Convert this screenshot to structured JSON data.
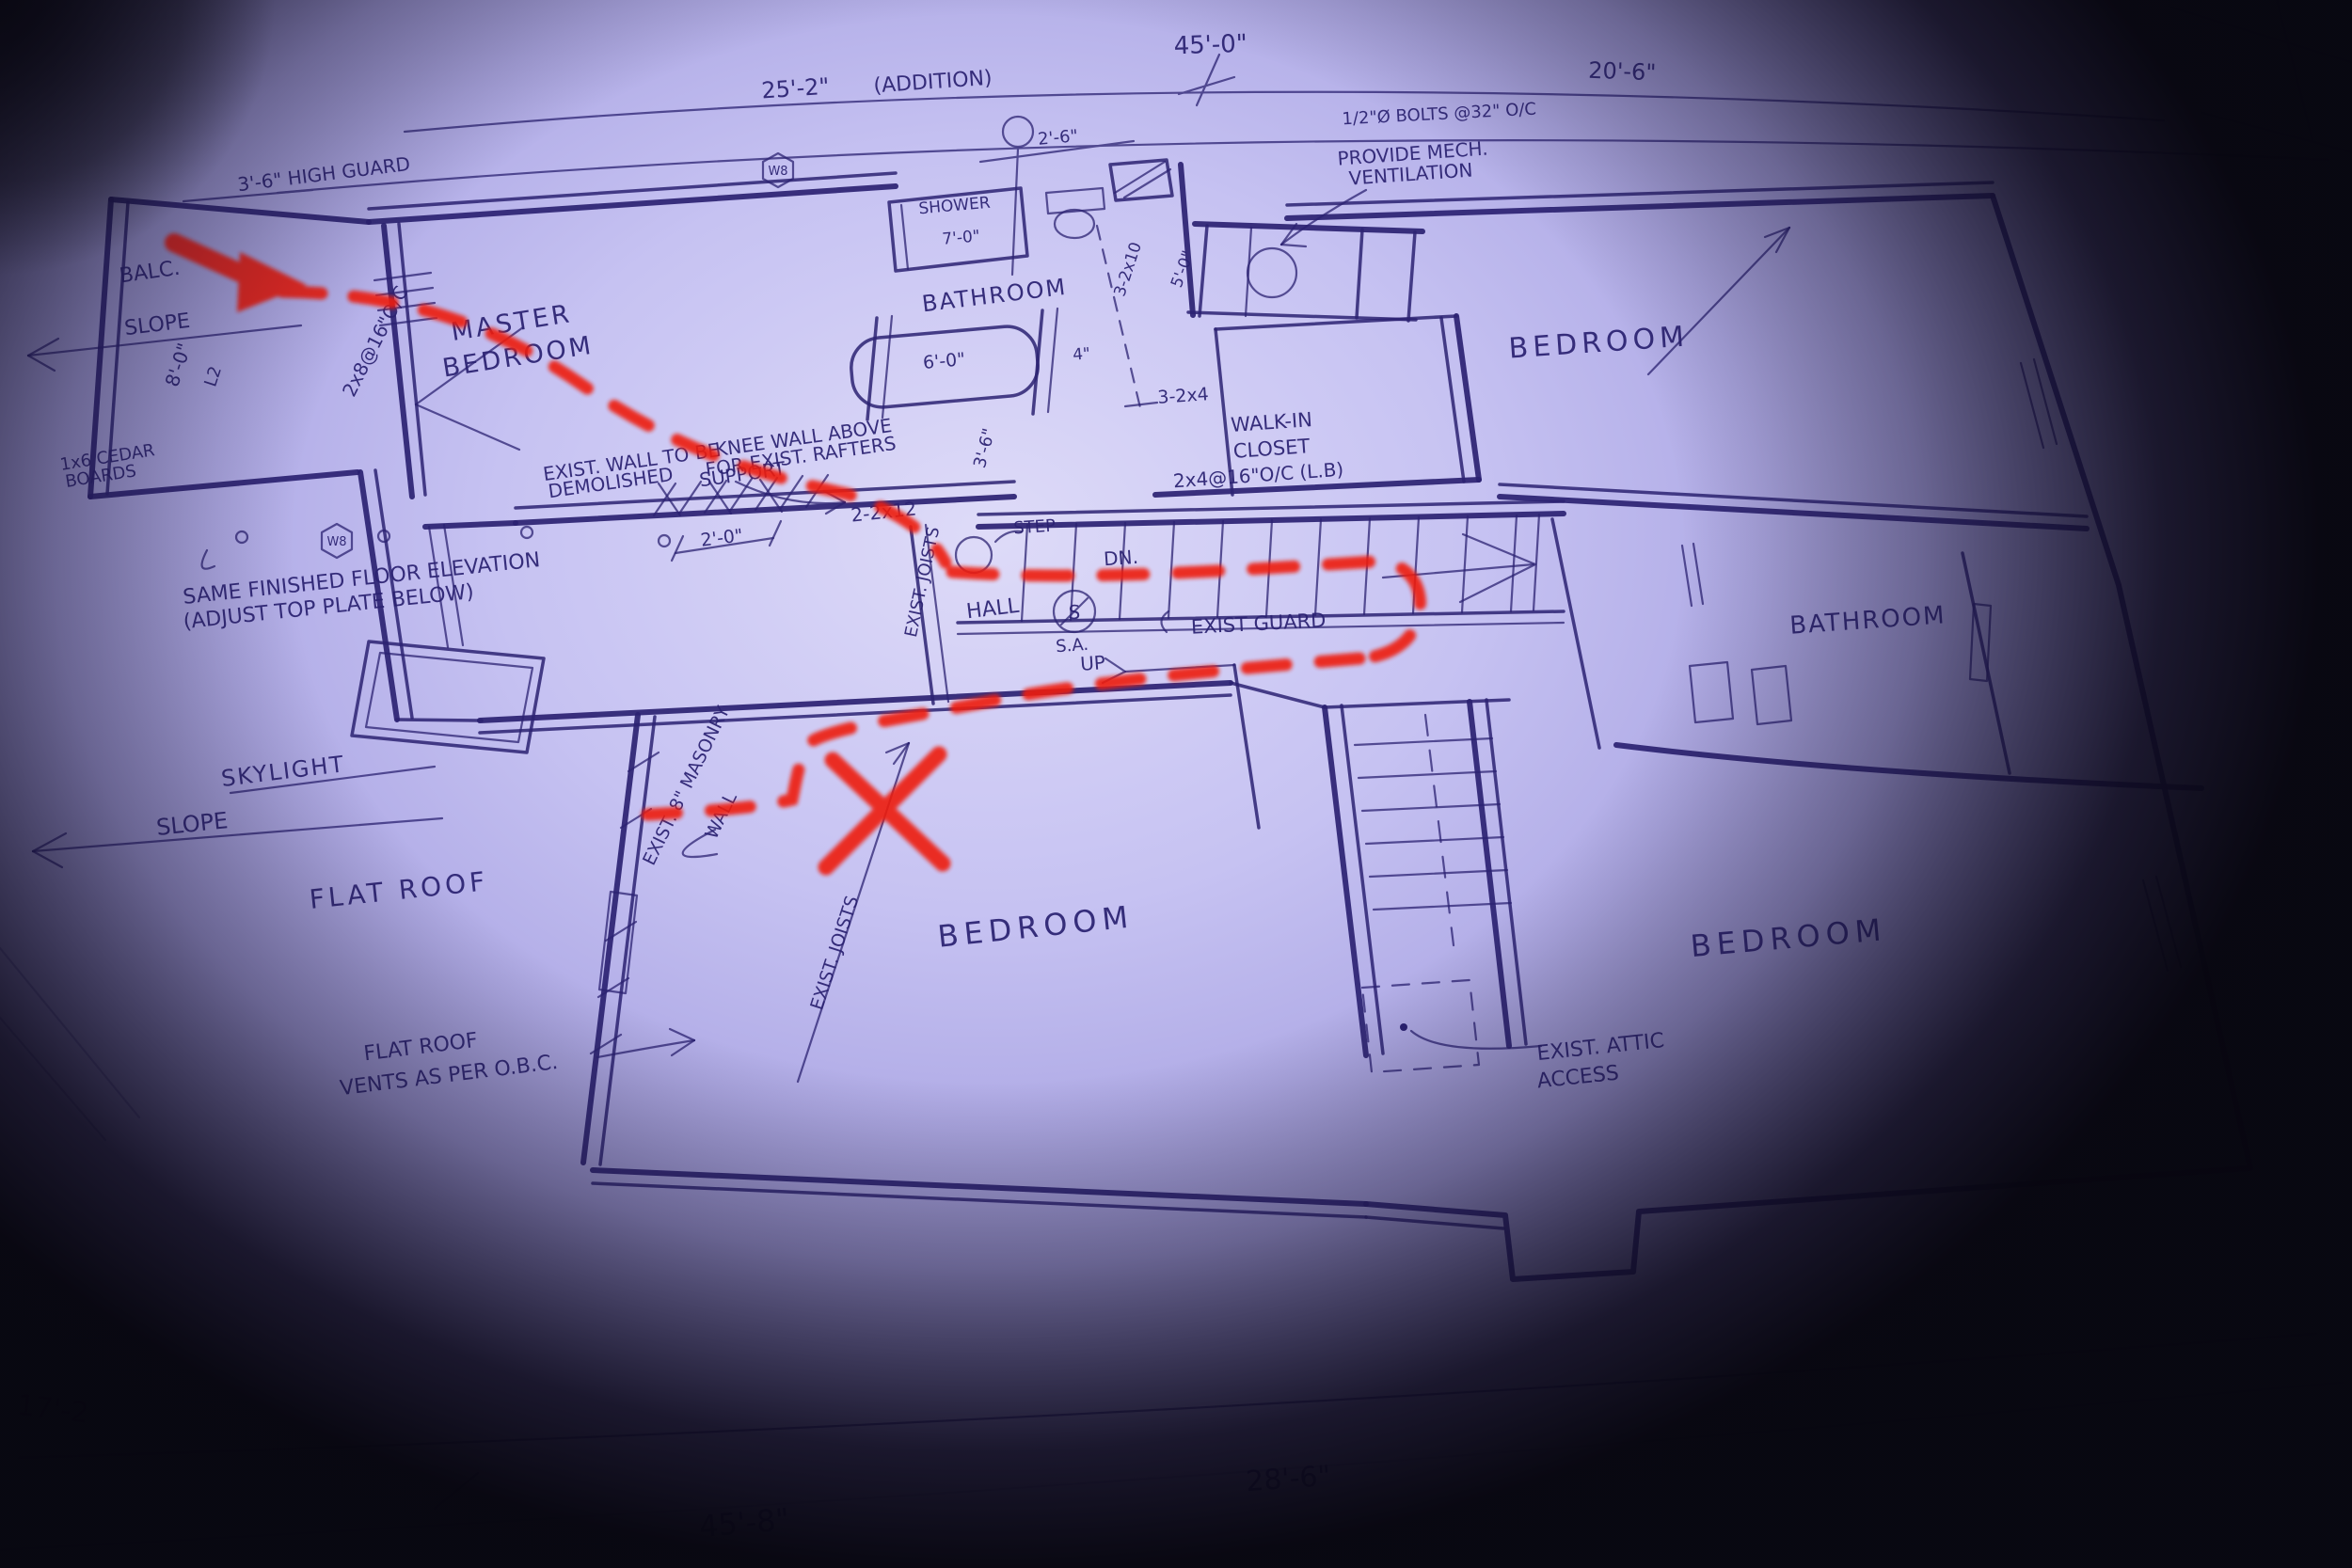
{
  "colors": {
    "ink": "#2b2272",
    "red": "#ee1d0e",
    "paper": "#c6c2f2",
    "vignette": "#0a0912"
  },
  "rooms": {
    "balcony": "BALC.",
    "master_line1": "MASTER",
    "master_line2": "BEDROOM",
    "bathroom_top": "BATHROOM",
    "bedroom_top_right": "BEDROOM",
    "walkin_line1": "WALK-IN",
    "walkin_line2": "CLOSET",
    "hall": "HALL",
    "bathroom_right": "BATHROOM",
    "bedroom_bottom_middle": "BEDROOM",
    "bedroom_bottom_right": "BEDROOM",
    "shower": "SHOWER",
    "skylight": "SKYLIGHT",
    "flat_roof": "FLAT ROOF"
  },
  "dims": {
    "overall_top": "45'-0\"",
    "addition_span": "25'-2\"",
    "addition_note": "(ADDITION)",
    "right_span": "20'-6\"",
    "toilet_clear": "2'-6\"",
    "shower_len": "7'-0\"",
    "tub_len": "6'-0\"",
    "gap": "4\"",
    "step_depth": "2'-0\"",
    "stair_head": "3'-6\"",
    "vent_width": "5'-0\"",
    "balc_width": "8'-0\"",
    "l2": "L2",
    "joist_spec": "2x8@16\"O/C",
    "beam_2x12": "2-2x12",
    "beam_3_2x10": "3-2x10",
    "post_3_2x4": "3-2x4",
    "stud_spec": "2x4@16\"O/C (L.B)",
    "bottom_mid": "28'-6\"",
    "bottom_left": "45'-8\"",
    "left_edge": "17'-2"
  },
  "notes": {
    "high_guard": "3'-6\" HIGH GUARD",
    "bolts": "1/2\"Ø BOLTS @32\" O/C",
    "provide_mech1": "PROVIDE MECH.",
    "provide_mech2": "VENTILATION",
    "demolish1": "EXIST. WALL TO BE",
    "demolish2": "DEMOLISHED",
    "knee1": "KNEE WALL ABOVE",
    "knee2": "FOR EXIST. RAFTERS",
    "knee3": "SUPPORT",
    "same_floor1": "SAME FINISHED FLOOR ELEVATION",
    "same_floor2": "(ADJUST TOP PLATE BELOW)",
    "cedar1": "1x6 CEDAR",
    "cedar2": "BOARDS",
    "slope_upper": "SLOPE",
    "slope_lower": "SLOPE",
    "masonry1": "EXIST. 8\" MASONRY",
    "masonry2": "WALL",
    "joists_hall": "EXIST. JOISTS",
    "joists_bed": "EXIST. JOISTS",
    "vents1": "FLAT ROOF",
    "vents2": "VENTS AS PER O.B.C.",
    "attic1": "EXIST. ATTIC",
    "attic2": "ACCESS",
    "exist_guard": "EXIST GUARD",
    "step": "STEP",
    "dn": "DN.",
    "up": "UP",
    "sa": "S.A.",
    "sa_symbol": "S",
    "w8": "W8"
  }
}
